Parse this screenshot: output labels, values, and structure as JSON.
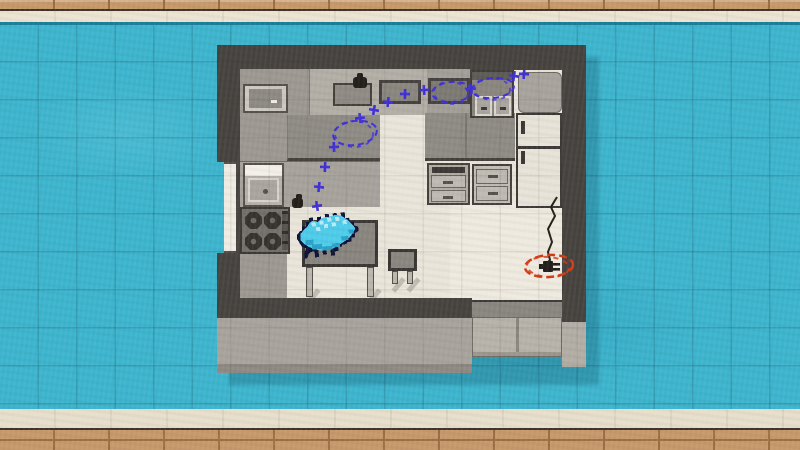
{
  "scene": {
    "name": "top-down-kitchen-floorplan-level",
    "colors": {
      "blue": "#3eb5ce",
      "blue_grid": "rgba(8,85,108,0.14)",
      "teal_line": "#1a7e99",
      "cream": "#ece4d2",
      "cream_bottom": "#e7dfcc",
      "brick": "#c6996b",
      "brick_joint": "#9c7044",
      "brick_edge": "#3f332a",
      "shadow": "rgba(13,66,86,0.25)",
      "wall": "#474440",
      "counter": "#9d9992",
      "counter_light": "#b3afa7",
      "counter_dark": "#8f8b85",
      "counter_edge": "#45423e",
      "floor": "#eae5da",
      "floor_light": "#efeadf",
      "apron": "#a8a49d",
      "apron_edge": "#8f8b84",
      "cabinet_front": "#b7b3ab",
      "white_fixture": "#f3f0e8",
      "basin": "#aaa69f",
      "drawer_face": "#bfbbb3",
      "fridge": "#e8e3d8",
      "stove": "#74706a",
      "burner": "#36332f",
      "burner_dot": "#6e6a64",
      "table": "#8a867f",
      "table_edge": "#3a3734",
      "leg": "#bcb7ae",
      "window": "#f0ece3",
      "ink": "#23201c",
      "annot_blue": "#4130d6",
      "annot_red": "#d23c17",
      "creature_body": "#4fccea",
      "creature_outline": "#0e1238",
      "creature_shade": "#2aa3c8",
      "creature_light": "#b7eaf5"
    },
    "grid": {
      "size": 37.5,
      "offset_x": 0.5,
      "offset_y": 24.5
    },
    "annotations": {
      "crosses": [
        [
          317,
          206
        ],
        [
          319,
          187
        ],
        [
          325,
          167
        ],
        [
          334,
          147
        ],
        [
          360,
          118
        ],
        [
          374,
          110
        ],
        [
          388,
          102
        ],
        [
          405,
          94
        ],
        [
          424,
          90
        ],
        [
          471,
          89
        ],
        [
          514,
          76
        ],
        [
          524,
          74
        ]
      ],
      "ellipses": [
        {
          "cx": 355,
          "cy": 133,
          "rx": 22,
          "ry": 12,
          "rot": -8
        },
        {
          "cx": 452,
          "cy": 92,
          "rx": 20,
          "ry": 10,
          "rot": -4
        },
        {
          "cx": 493,
          "cy": 88,
          "rx": 21,
          "ry": 10,
          "rot": -6
        }
      ],
      "target": {
        "ellipse": {
          "cx": 549,
          "cy": 266,
          "rx": 24,
          "ry": 11,
          "rot": -4
        },
        "cord": [
          [
            557,
            197
          ],
          [
            551,
            207
          ],
          [
            555,
            216
          ],
          [
            548,
            229
          ],
          [
            552,
            242
          ],
          [
            548,
            252
          ],
          [
            550,
            260
          ],
          [
            548,
            262
          ]
        ],
        "plug": {
          "x": 543,
          "y": 261
        }
      }
    },
    "objects": [
      "microwave",
      "kettle",
      "cutting-board",
      "counter-inset",
      "counter-inset",
      "double-sink",
      "corner-cabinet",
      "fridge",
      "sink",
      "stove",
      "oven",
      "drawer-unit",
      "kettle",
      "table",
      "stool",
      "creature-dino",
      "wall-outlet-plug",
      "window"
    ]
  }
}
